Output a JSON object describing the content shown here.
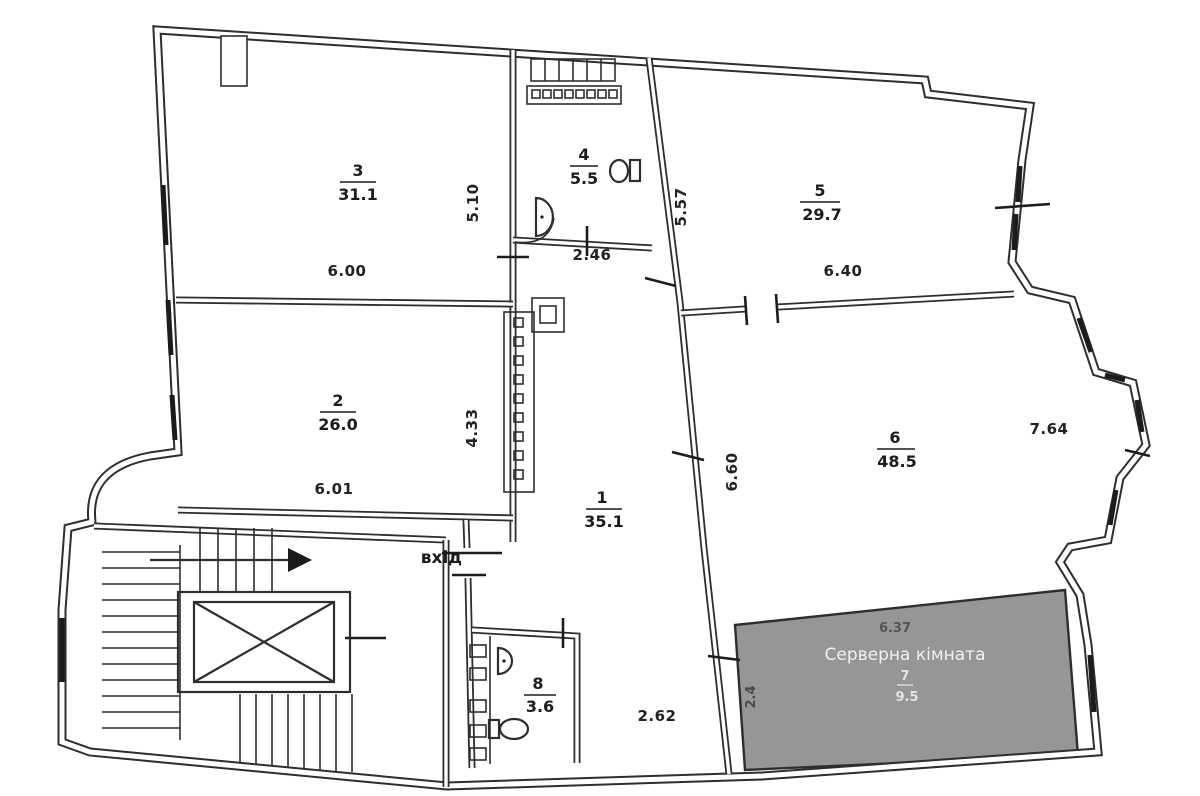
{
  "plan": {
    "type": "floor-plan",
    "background": "#ffffff",
    "ink": "#2e2e2e",
    "server_fill": "#969696",
    "server_text_color": "#f1f1f1"
  },
  "rooms": {
    "r1": {
      "number": "1",
      "area": "35.1"
    },
    "r2": {
      "number": "2",
      "area": "26.0"
    },
    "r3": {
      "number": "3",
      "area": "31.1"
    },
    "r4": {
      "number": "4",
      "area": "5.5"
    },
    "r5": {
      "number": "5",
      "area": "29.7"
    },
    "r6": {
      "number": "6",
      "area": "48.5"
    },
    "r7": {
      "number": "7",
      "area": "9.5",
      "name": "Серверна кімната"
    },
    "r8": {
      "number": "8",
      "area": "3.6"
    }
  },
  "dimensions": {
    "room3_width": "6.00",
    "room3_height": "5.10",
    "room4_width": "2.46",
    "corridor_height": "5.57",
    "room5_width": "6.40",
    "room2_width": "6.01",
    "room2_height": "4.33",
    "room6_height": "6.60",
    "room6_width": "7.64",
    "hall_width": "2.62",
    "server_width": "6.37",
    "server_height": "2.4"
  },
  "labels": {
    "entrance": "вхід"
  }
}
